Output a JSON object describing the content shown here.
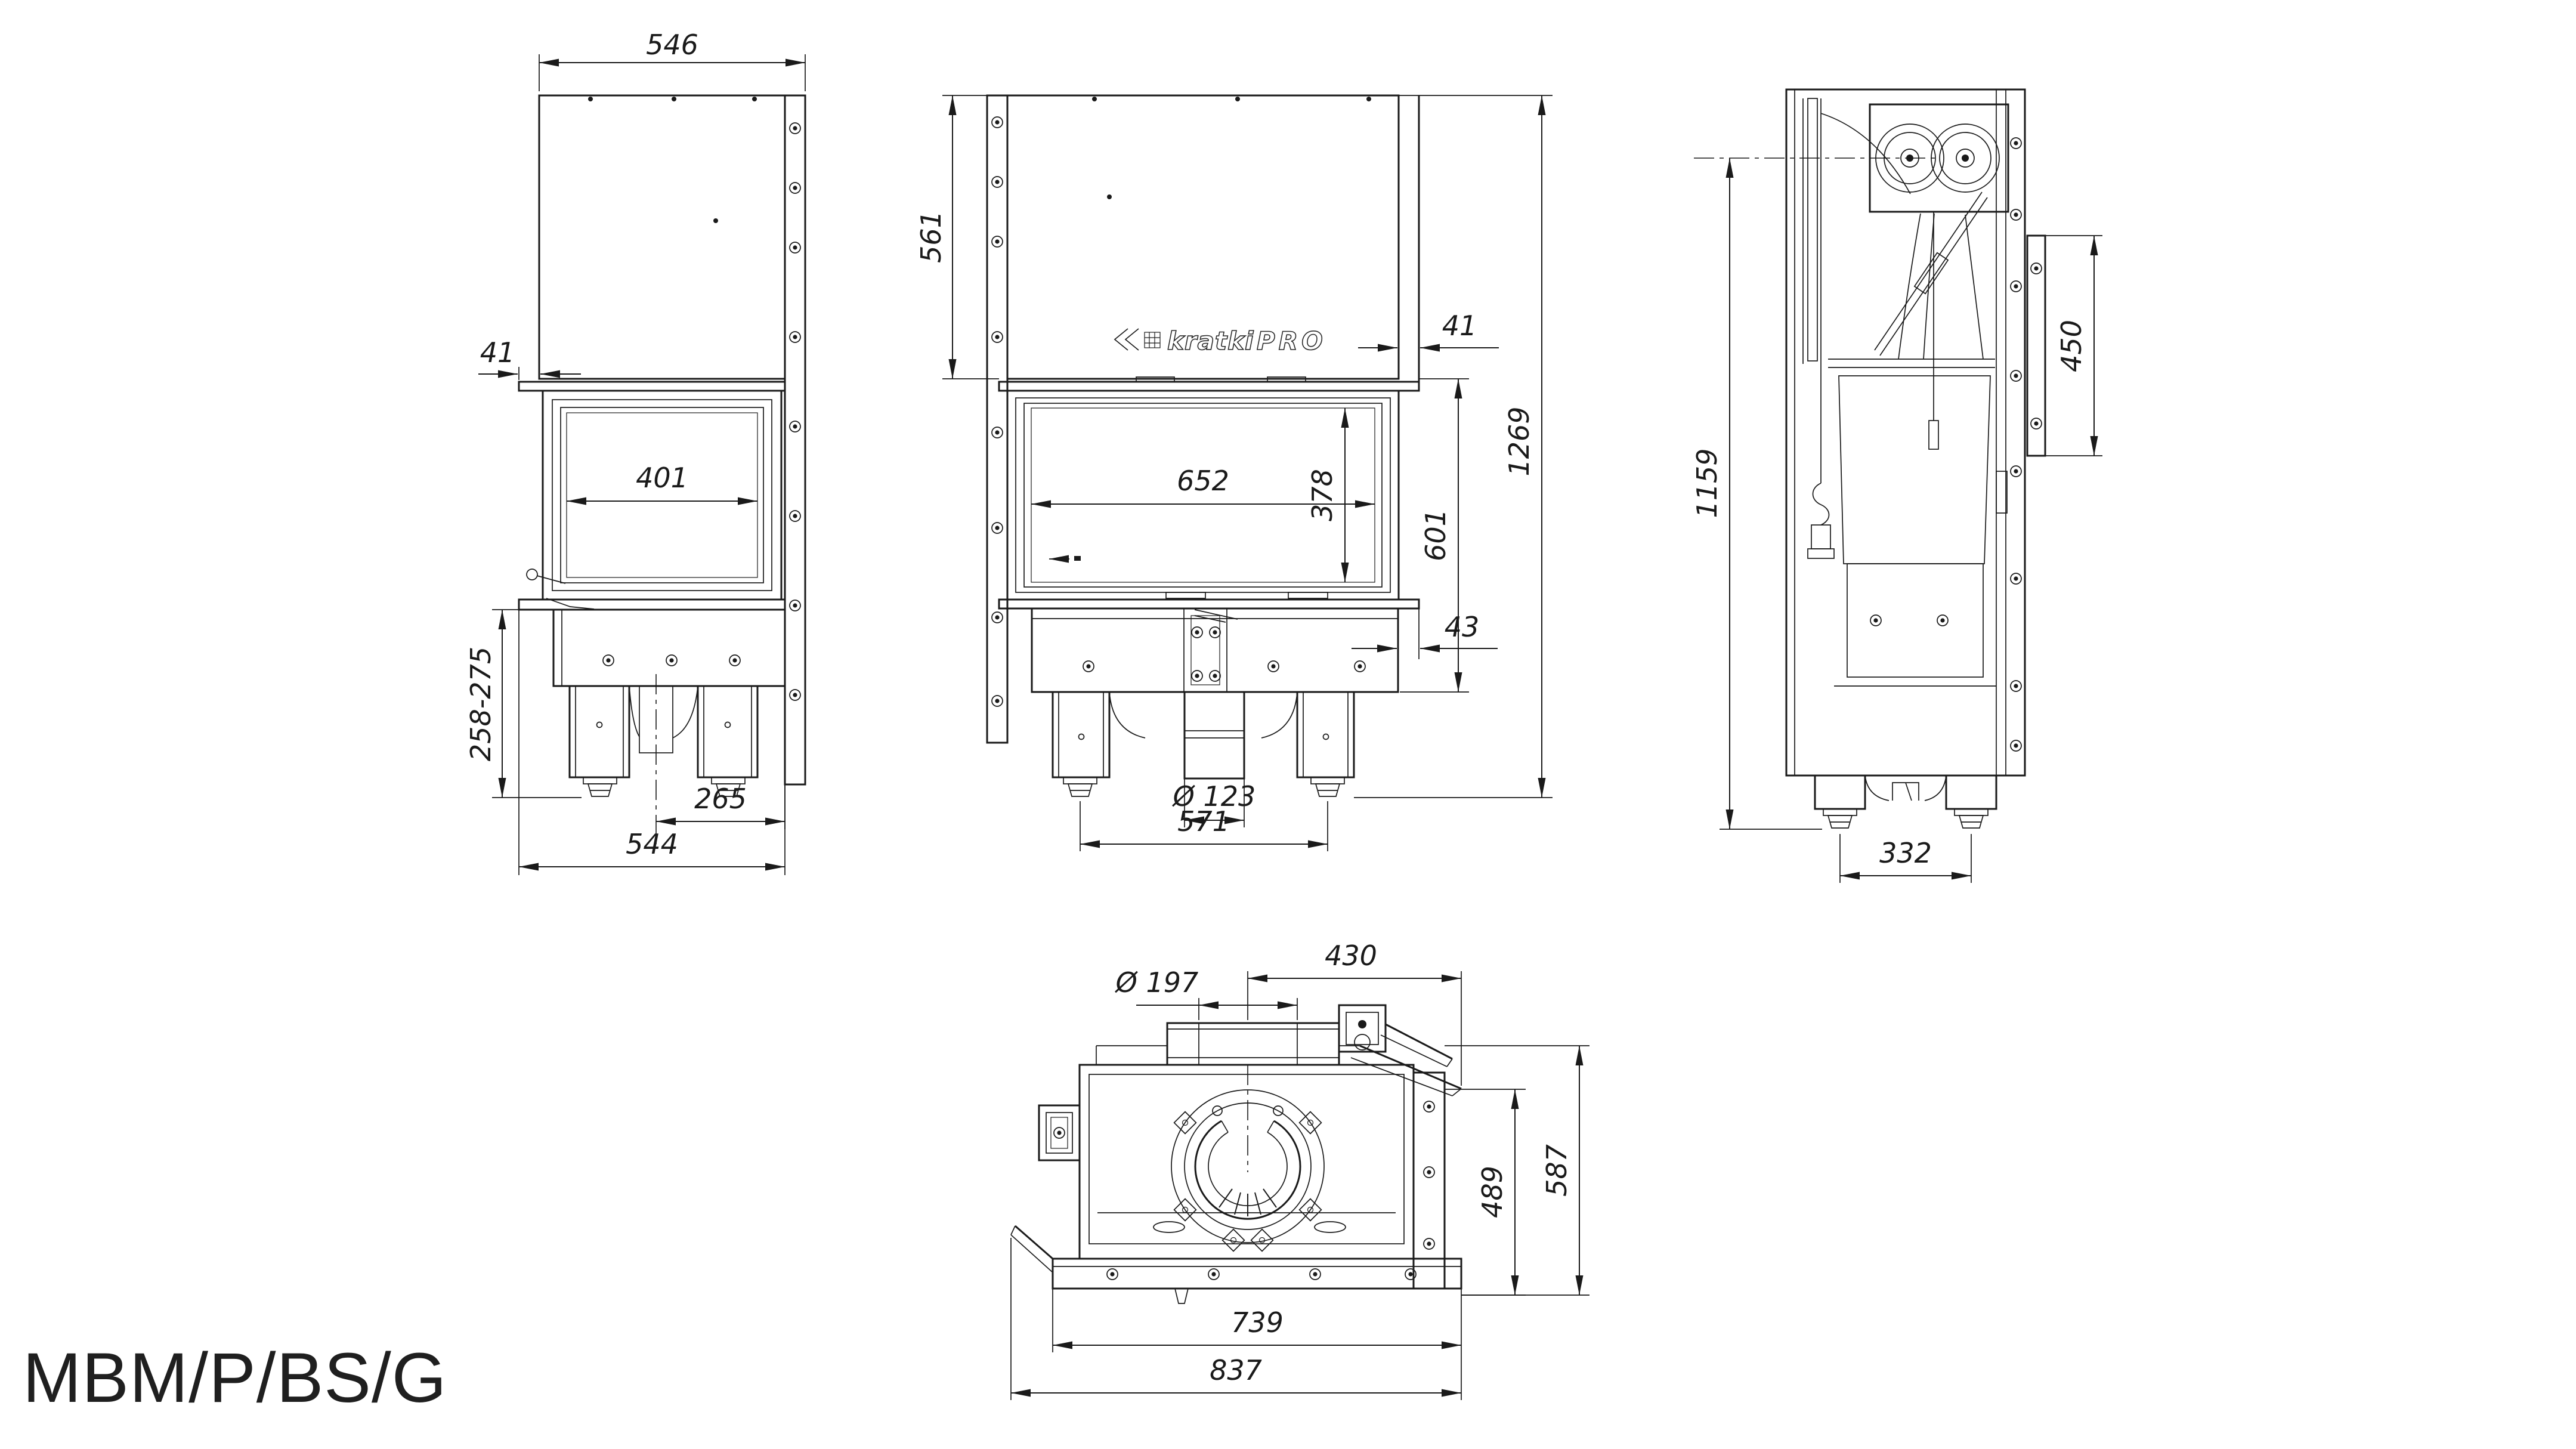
{
  "model_label": "MBM/P/BS/G",
  "brand": {
    "name": "kratki",
    "suffix": "PRO"
  },
  "line_color": "#1a1a1a",
  "views": {
    "side": {
      "dims": {
        "hood_depth": "546",
        "front_offset": "41",
        "glass_width": "401",
        "base_height_range": "258-275",
        "center_to_rear": "265",
        "total_depth": "544"
      }
    },
    "front": {
      "dims": {
        "hood_height": "561",
        "side_offset": "41",
        "glass_width": "652",
        "glass_height": "378",
        "firebox_height": "601",
        "total_height": "1269",
        "base_inset": "43",
        "air_inlet_diameter": "Ø 123",
        "feet_spacing": "571"
      }
    },
    "section": {
      "dims": {
        "height_to_flue_axis": "1159",
        "rear_panel_height": "450",
        "feet_spacing": "332"
      }
    },
    "top": {
      "dims": {
        "flue_center_to_right": "430",
        "flue_diameter": "Ø 197",
        "body_depth": "489",
        "total_depth": "587",
        "body_width": "739",
        "total_width": "837"
      }
    }
  }
}
